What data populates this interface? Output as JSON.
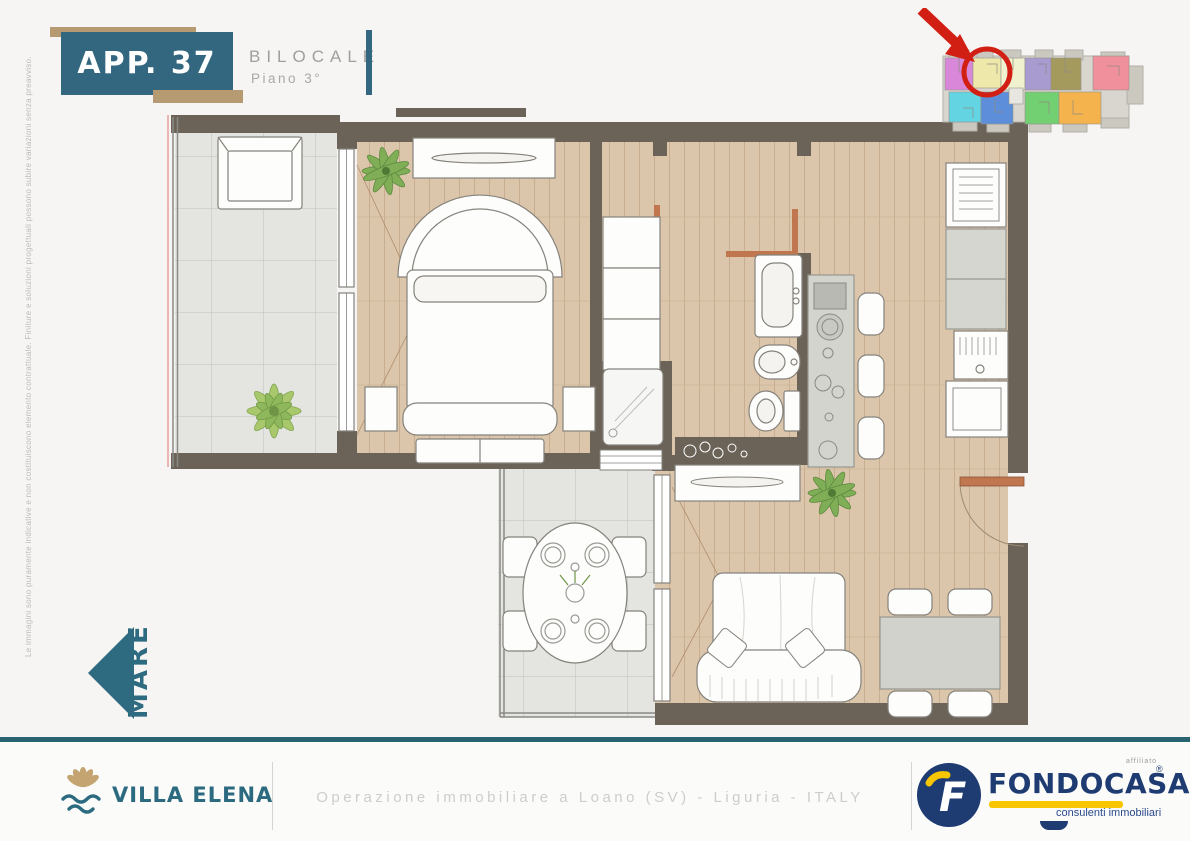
{
  "page": {
    "background": "#f6f5f3"
  },
  "header": {
    "apartment_label": "APP. 37",
    "type_label": "BILOCALE",
    "floor_label": "Piano 3°",
    "badge_color": "#33677f",
    "accent_tan": "#b59a72"
  },
  "key_plan": {
    "highlight_color": "#d21f14",
    "unit_colors": [
      "#d987d9",
      "#eee8ab",
      "#eff1cf",
      "#a79bd0",
      "#a59a5e",
      "#f0909c",
      "#63d4e2",
      "#5c8ed9",
      "#72cf72",
      "#f5b34d"
    ]
  },
  "left_margin": {
    "disclaimer": "Le immagini sono puramente indicative e non costituiscono elemento contrattuale. Finiture e soluzioni progettuali possono subire variazioni senza preavviso."
  },
  "compass": {
    "label": "MARE"
  },
  "colors": {
    "brand_teal": "#2e6b80",
    "wall": "#6b6258",
    "wood_floor": "#dcc6ab",
    "terrace_tile": "#e4e4e1",
    "door_accent": "#c0764f"
  },
  "footer": {
    "developer_name": "VILLA ELENA",
    "location_text": "Operazione immobiliare a Loano (SV) - Liguria - ITALY",
    "agency_name": "FONDOCASA",
    "agency_tagline": "consulenti immobiliari",
    "agency_affiliation": "affiliato",
    "registered_mark": "®"
  }
}
